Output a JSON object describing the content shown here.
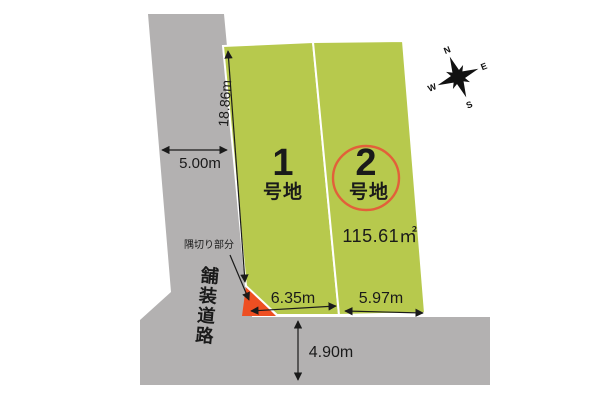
{
  "plots": {
    "plot1": {
      "number": "1",
      "suffix": "号地",
      "frontage": "6.35m"
    },
    "plot2": {
      "number": "2",
      "suffix": "号地",
      "frontage": "5.97m",
      "area": "115.61㎡"
    }
  },
  "dimensions": {
    "west_boundary": "18.86m",
    "road_width_west": "5.00m",
    "plot1_frontage": "6.35m",
    "plot2_frontage": "5.97m",
    "road_width_south": "4.90m"
  },
  "labels": {
    "corner_cut": "隅切り部分",
    "paved_road": "舗装道路"
  },
  "compass": {
    "north": "N",
    "east": "E",
    "south": "S",
    "west": "W"
  },
  "colors": {
    "plot_green": "#b7c94d",
    "road_gray": "#b3b1b1",
    "corner_cut_red": "#ee4f22",
    "highlight_circle_red": "#e2603a",
    "line_black": "#1a1a1a"
  }
}
